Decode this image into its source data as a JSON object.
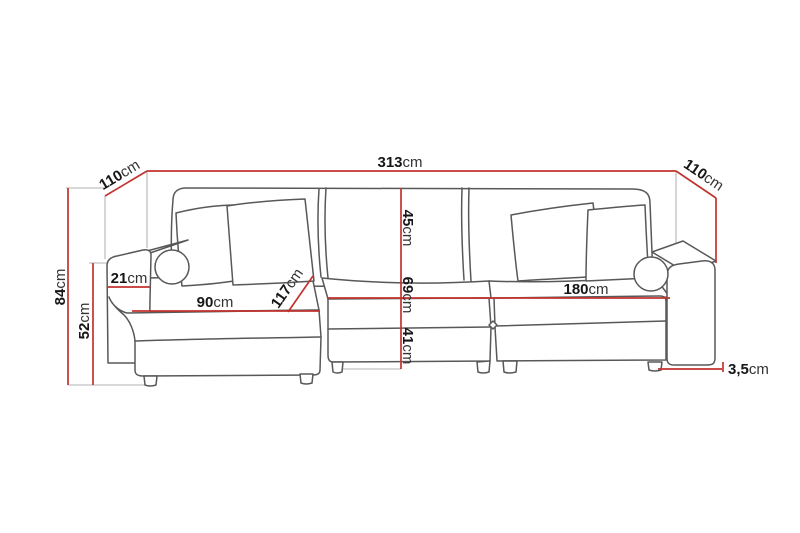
{
  "diagram": "corner-sofa-dimension-drawing",
  "unit_default": "cm",
  "dimensions": {
    "total_width": {
      "number": "313",
      "unit": "cm"
    },
    "depth_left": {
      "number": "110",
      "unit": "cm"
    },
    "depth_right": {
      "number": "110",
      "unit": "cm"
    },
    "total_height": {
      "number": "84",
      "unit": "cm"
    },
    "armrest_height": {
      "number": "52",
      "unit": "cm"
    },
    "armrest_width": {
      "number": "21",
      "unit": "cm"
    },
    "chaise_width": {
      "number": "90",
      "unit": "cm"
    },
    "chaise_depth": {
      "number": "117",
      "unit": "cm"
    },
    "backrest_height": {
      "number": "45",
      "unit": "cm"
    },
    "seat_depth": {
      "number": "69",
      "unit": "cm"
    },
    "seat_height": {
      "number": "41",
      "unit": "cm"
    },
    "seat_width": {
      "number": "180",
      "unit": "cm"
    },
    "leg_height": {
      "number": "3,5",
      "unit": "cm"
    }
  },
  "colors": {
    "dimension": "#c2332e",
    "sketch": "#58585a",
    "construction": "#b3b3b3",
    "text": "#161616",
    "unit_text": "#333333",
    "background": "#ffffff"
  }
}
